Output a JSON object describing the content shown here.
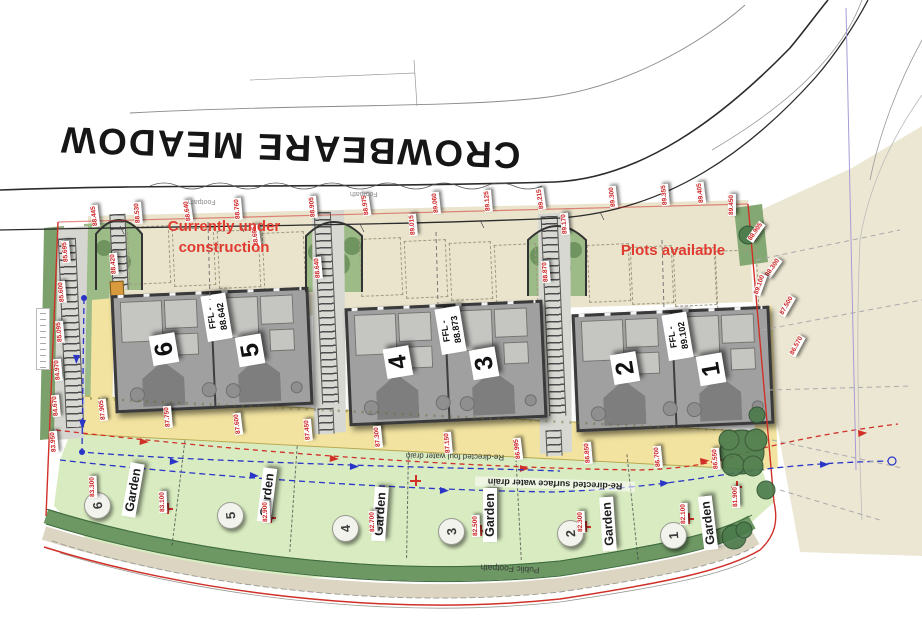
{
  "road_name": "CROWBEARE MEADOW",
  "annotations": {
    "under_construction": "Currently under construction",
    "plots_available": "Plots available"
  },
  "drains": {
    "foul": "Re-directed foul water drain",
    "surface": "Re-directed surface water drain"
  },
  "footpath_label": "Public Footpath",
  "faint_labels": {
    "footpath": "Footpath"
  },
  "colors": {
    "site_boundary_red": "#d03028",
    "annotation_red": "#e03b30",
    "drain_blue": "#2a35c8",
    "garden_green": "#d9ecc1",
    "hedge_green": "#6d9763",
    "terrace_yellow": "#f2e3a0",
    "parking_beige": "#eae4cd",
    "block_gray": "#a0a0a0"
  },
  "blocks": [
    {
      "n1": "6",
      "n2": "5",
      "ffl_label": "FFL -",
      "ffl_value": "88.642",
      "x": 113,
      "y": 291,
      "r": -2.5
    },
    {
      "n1": "4",
      "n2": "3",
      "ffl_label": "FFL -",
      "ffl_value": "88.873",
      "x": 347,
      "y": 304,
      "r": -2.5
    },
    {
      "n1": "2",
      "n2": "1",
      "ffl_label": "FFL -",
      "ffl_value": "89.102",
      "x": 574,
      "y": 310,
      "r": -2.5
    }
  ],
  "gardens_circles": [
    {
      "num": "6",
      "x": 84,
      "y": 492
    },
    {
      "num": "5",
      "x": 217,
      "y": 502
    },
    {
      "num": "4",
      "x": 332,
      "y": 515
    },
    {
      "num": "3",
      "x": 438,
      "y": 518
    },
    {
      "num": "2",
      "x": 557,
      "y": 520
    },
    {
      "num": "1",
      "x": 660,
      "y": 522
    }
  ],
  "gardens_labels": [
    {
      "label": "Garden",
      "x": 106,
      "y": 483,
      "r": -80
    },
    {
      "label": "Garden",
      "x": 240,
      "y": 488,
      "r": -83
    },
    {
      "label": "Garden",
      "x": 353,
      "y": 507,
      "r": -86
    },
    {
      "label": "Garden",
      "x": 463,
      "y": 508,
      "r": -90
    },
    {
      "label": "Garden",
      "x": 581,
      "y": 517,
      "r": -94
    },
    {
      "label": "Garden",
      "x": 681,
      "y": 516,
      "r": -97
    }
  ],
  "garden_dividers": [
    {
      "x": 178,
      "y": 440,
      "r": 7
    },
    {
      "x": 293,
      "y": 446,
      "r": 4
    },
    {
      "x": 407,
      "y": 452,
      "r": 1
    },
    {
      "x": 518,
      "y": 454,
      "r": -3
    },
    {
      "x": 632,
      "y": 454,
      "r": -6
    }
  ],
  "bays": [
    {
      "x": 128,
      "y": 226
    },
    {
      "x": 173,
      "y": 228
    },
    {
      "x": 218,
      "y": 230
    },
    {
      "x": 263,
      "y": 232
    },
    {
      "x": 360,
      "y": 238
    },
    {
      "x": 405,
      "y": 240
    },
    {
      "x": 450,
      "y": 242
    },
    {
      "x": 495,
      "y": 244
    },
    {
      "x": 588,
      "y": 244
    },
    {
      "x": 631,
      "y": 246
    },
    {
      "x": 674,
      "y": 248
    },
    {
      "x": 716,
      "y": 250
    }
  ],
  "spot_levels": [
    {
      "v": "88.445",
      "x": 84,
      "y": 212,
      "r": -97
    },
    {
      "v": "88.530",
      "x": 127,
      "y": 209,
      "r": -95
    },
    {
      "v": "88.640",
      "x": 177,
      "y": 207,
      "r": -98
    },
    {
      "v": "88.760",
      "x": 227,
      "y": 205,
      "r": -95
    },
    {
      "v": "88.695",
      "x": 245,
      "y": 232,
      "r": -97
    },
    {
      "v": "88.905",
      "x": 302,
      "y": 203,
      "r": -95
    },
    {
      "v": "88.975",
      "x": 355,
      "y": 201,
      "r": -98
    },
    {
      "v": "89.015",
      "x": 402,
      "y": 221,
      "r": -95
    },
    {
      "v": "89.060",
      "x": 425,
      "y": 199,
      "r": -96
    },
    {
      "v": "89.125",
      "x": 477,
      "y": 197,
      "r": -95
    },
    {
      "v": "89.215",
      "x": 530,
      "y": 195,
      "r": -98
    },
    {
      "v": "89.170",
      "x": 554,
      "y": 220,
      "r": -95
    },
    {
      "v": "89.300",
      "x": 602,
      "y": 193,
      "r": -96
    },
    {
      "v": "89.355",
      "x": 654,
      "y": 191,
      "r": -95
    },
    {
      "v": "89.405",
      "x": 690,
      "y": 189,
      "r": -97
    },
    {
      "v": "89.450",
      "x": 721,
      "y": 201,
      "r": -90
    },
    {
      "v": "88.905",
      "x": 745,
      "y": 228,
      "r": -55
    },
    {
      "v": "88.300",
      "x": 762,
      "y": 264,
      "r": -55
    },
    {
      "v": "87.500",
      "x": 776,
      "y": 302,
      "r": -60
    },
    {
      "v": "86.570",
      "x": 786,
      "y": 342,
      "r": -62
    },
    {
      "v": "85.695",
      "x": 55,
      "y": 248,
      "r": -95
    },
    {
      "v": "85.600",
      "x": 51,
      "y": 288,
      "r": -95
    },
    {
      "v": "85.095",
      "x": 49,
      "y": 328,
      "r": -95
    },
    {
      "v": "84.970",
      "x": 47,
      "y": 366,
      "r": -95
    },
    {
      "v": "84.670",
      "x": 45,
      "y": 402,
      "r": -95
    },
    {
      "v": "83.950",
      "x": 43,
      "y": 438,
      "r": -95
    },
    {
      "v": "87.905",
      "x": 92,
      "y": 406,
      "r": -96
    },
    {
      "v": "87.750",
      "x": 157,
      "y": 413,
      "r": -95
    },
    {
      "v": "87.600",
      "x": 227,
      "y": 420,
      "r": -97
    },
    {
      "v": "87.450",
      "x": 297,
      "y": 426,
      "r": -95
    },
    {
      "v": "87.300",
      "x": 367,
      "y": 433,
      "r": -96
    },
    {
      "v": "87.150",
      "x": 437,
      "y": 439,
      "r": -95
    },
    {
      "v": "86.995",
      "x": 507,
      "y": 445,
      "r": -97
    },
    {
      "v": "86.850",
      "x": 577,
      "y": 449,
      "r": -95
    },
    {
      "v": "86.700",
      "x": 647,
      "y": 453,
      "r": -96
    },
    {
      "v": "86.550",
      "x": 705,
      "y": 455,
      "r": -95
    },
    {
      "v": "88.640",
      "x": 307,
      "y": 264,
      "r": -95
    },
    {
      "v": "88.870",
      "x": 535,
      "y": 268,
      "r": -95
    },
    {
      "v": "88.420",
      "x": 103,
      "y": 260,
      "r": -95
    },
    {
      "v": "89.100",
      "x": 749,
      "y": 281,
      "r": -70
    },
    {
      "v": "83.300",
      "x": 82,
      "y": 483,
      "r": -92
    },
    {
      "v": "83.100",
      "x": 152,
      "y": 498,
      "r": -92
    },
    {
      "v": "82.900",
      "x": 255,
      "y": 508,
      "r": -92
    },
    {
      "v": "82.700",
      "x": 362,
      "y": 518,
      "r": -92
    },
    {
      "v": "82.500",
      "x": 465,
      "y": 522,
      "r": -92
    },
    {
      "v": "82.300",
      "x": 570,
      "y": 518,
      "r": -92
    },
    {
      "v": "82.100",
      "x": 673,
      "y": 510,
      "r": -92
    },
    {
      "v": "81.900",
      "x": 725,
      "y": 493,
      "r": -92
    }
  ],
  "crosses": [
    {
      "x": 162,
      "y": 503
    },
    {
      "x": 265,
      "y": 512
    },
    {
      "x": 373,
      "y": 522
    },
    {
      "x": 475,
      "y": 525
    },
    {
      "x": 580,
      "y": 521
    },
    {
      "x": 683,
      "y": 513
    },
    {
      "x": 731,
      "y": 481
    },
    {
      "x": 410,
      "y": 475
    }
  ]
}
